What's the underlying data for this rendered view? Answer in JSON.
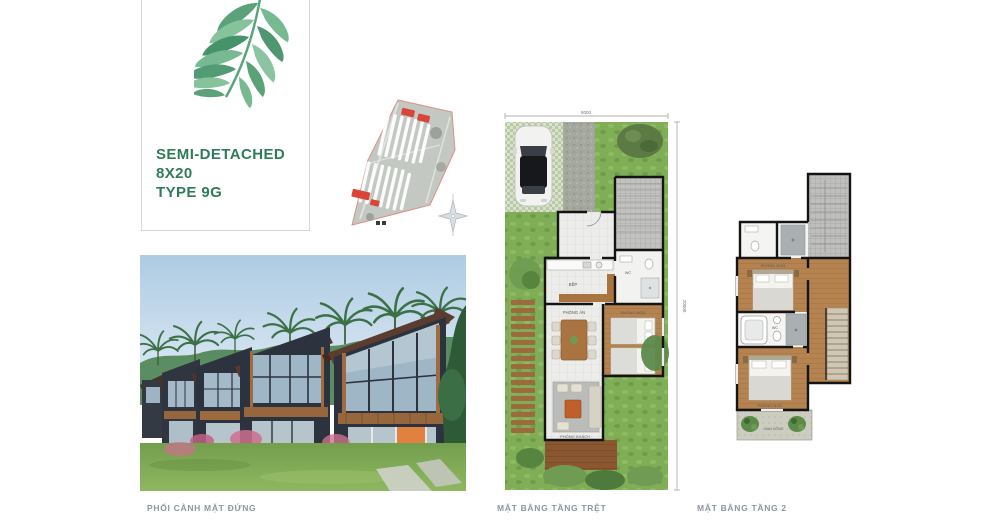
{
  "colors": {
    "accent_green": "#2f7d58",
    "caption_gray": "#8d95a5",
    "site_highlight_red": "#d94538",
    "plan_grass": "#7fae57",
    "wood_floor": "#b5834f",
    "plan_wall": "#141414",
    "render_sky": "#b7d3e8",
    "render_house_body": "#2c333e",
    "render_roof_wood": "#5b3d2f"
  },
  "title_card": {
    "lines": [
      "SEMI-DETACHED",
      "8X20",
      "TYPE 9G"
    ]
  },
  "captions": {
    "render": "PHỐI CẢNH MẶT ĐỨNG",
    "floor1": "MẶT BẰNG TẦNG TRỆT",
    "floor2": "MẶT BẰNG TẦNG 2"
  },
  "floor1": {
    "dim_width": "8000",
    "dim_depth": "20000",
    "rooms": {
      "kitchen": "BẾP",
      "wc": "WC",
      "dining": "PHÒNG ĂN",
      "bedroom": "PHÒNG NGỦ",
      "living": "PHÒNG KHÁCH"
    }
  },
  "floor2": {
    "rooms": {
      "bedroom1": "PHÒNG NGỦ",
      "bathroom": "WC",
      "bedroom2": "PHÒNG NGỦ",
      "balcony": "BAN CÔNG"
    }
  },
  "icons": {
    "leaf": "tropical-leaf-watercolor",
    "compass": "compass-rose",
    "site_plan": "master-plan-thumbnail",
    "car": "car-top-view"
  }
}
